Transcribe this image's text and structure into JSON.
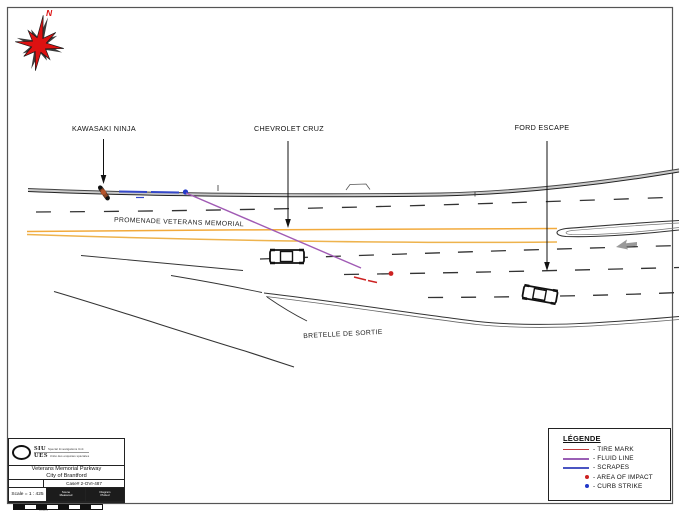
{
  "page": {
    "background": "#ffffff",
    "border_color": "#555555"
  },
  "compass": {
    "label": "N",
    "color": "#dd1111"
  },
  "vehicle_labels": [
    {
      "id": "kawasaki",
      "label": "KAWASAKI NINJA"
    },
    {
      "id": "chevrolet",
      "label": "CHEVROLET CRUZ"
    },
    {
      "id": "ford",
      "label": "FORD ESCAPE"
    }
  ],
  "road_labels": [
    {
      "id": "promenade",
      "label": "PROMENADE VETERANS MEMORIAL"
    },
    {
      "id": "bretelle",
      "label": "BRETELLE DE SORTIE"
    }
  ],
  "legend": {
    "title": "LÉGENDE",
    "items": [
      {
        "label": "- TIRE MARK",
        "swatch": "line",
        "color": "#c23a3a"
      },
      {
        "label": "- FLUID LINE",
        "swatch": "line",
        "color": "#9a5fb5"
      },
      {
        "label": "- SCRAPES",
        "swatch": "line",
        "color": "#4a55c2"
      },
      {
        "label": "- AREA OF IMPACT",
        "swatch": "dot",
        "color": "#cc2222"
      },
      {
        "label": "- CURB STRIKE",
        "swatch": "dot",
        "color": "#2238c8"
      }
    ]
  },
  "title_block": {
    "org_abbr1": "SIU",
    "org_abbr2": "UES",
    "org_sub1": "Special Investigations Unit",
    "org_sub2": "Unité des enquêtes spéciales",
    "road": "Veterans Memorial Parkway",
    "city": "City of Brantford",
    "case": "Case# 2-OVI-487",
    "scale": "Scale = 1 : 425",
    "cell_a_line1": "Scene",
    "cell_a_line2": "Measured",
    "cell_b_line1": "Diagram",
    "cell_b_line2": "Plotted",
    "scale_bar_label": "metres"
  },
  "evidence_colors": {
    "tire_mark": "#cc2222",
    "fluid_line": "#a05ab4",
    "scrapes": "#3548c8",
    "area_of_impact": "#cc2222",
    "curb_strike": "#2238c8",
    "road_yellow": "#f2aa3c"
  }
}
